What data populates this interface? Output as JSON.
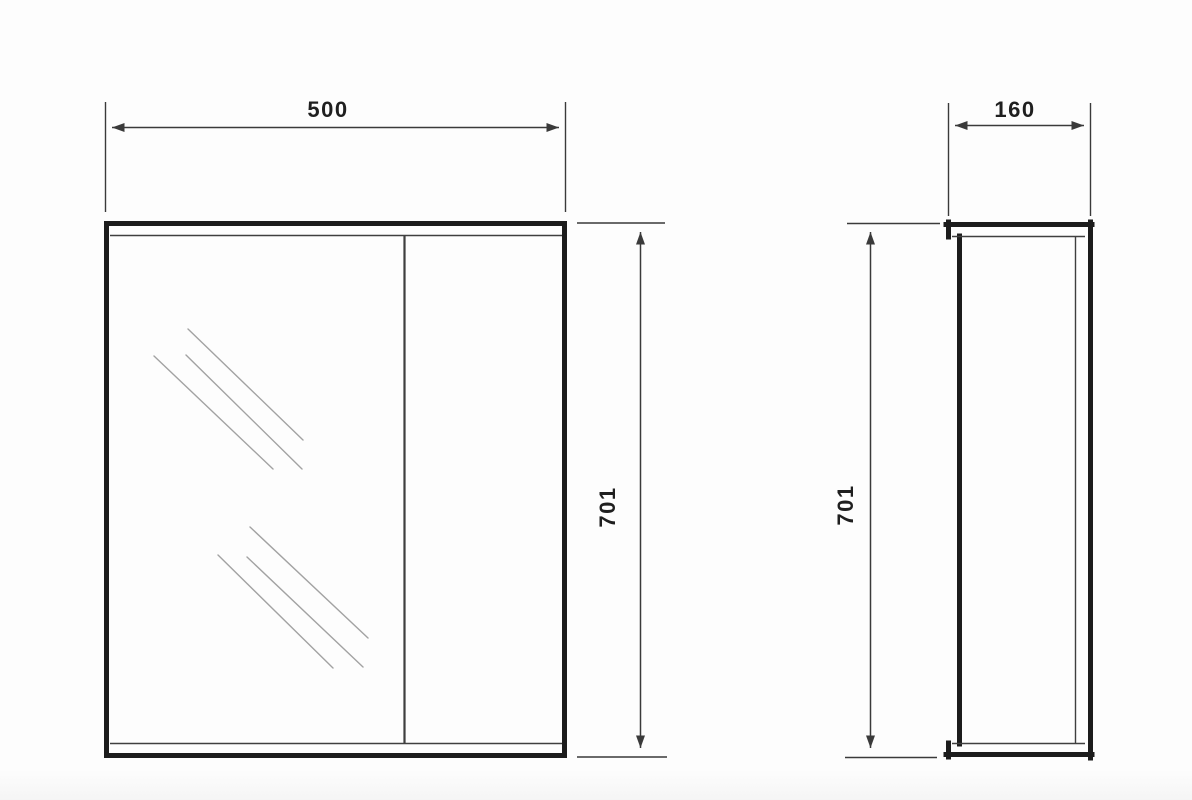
{
  "drawing": {
    "front_view": {
      "width_label": "500",
      "height_label": "701"
    },
    "side_view": {
      "depth_label": "160",
      "height_label": "701"
    },
    "colors": {
      "outline": "#1c1c1c",
      "thin_line": "#3f3f3f",
      "dimension_line": "#3a3a3a",
      "hatch_line": "#a2a2a2",
      "text": "#1f1f1f",
      "background": "#fdfdfd"
    }
  }
}
